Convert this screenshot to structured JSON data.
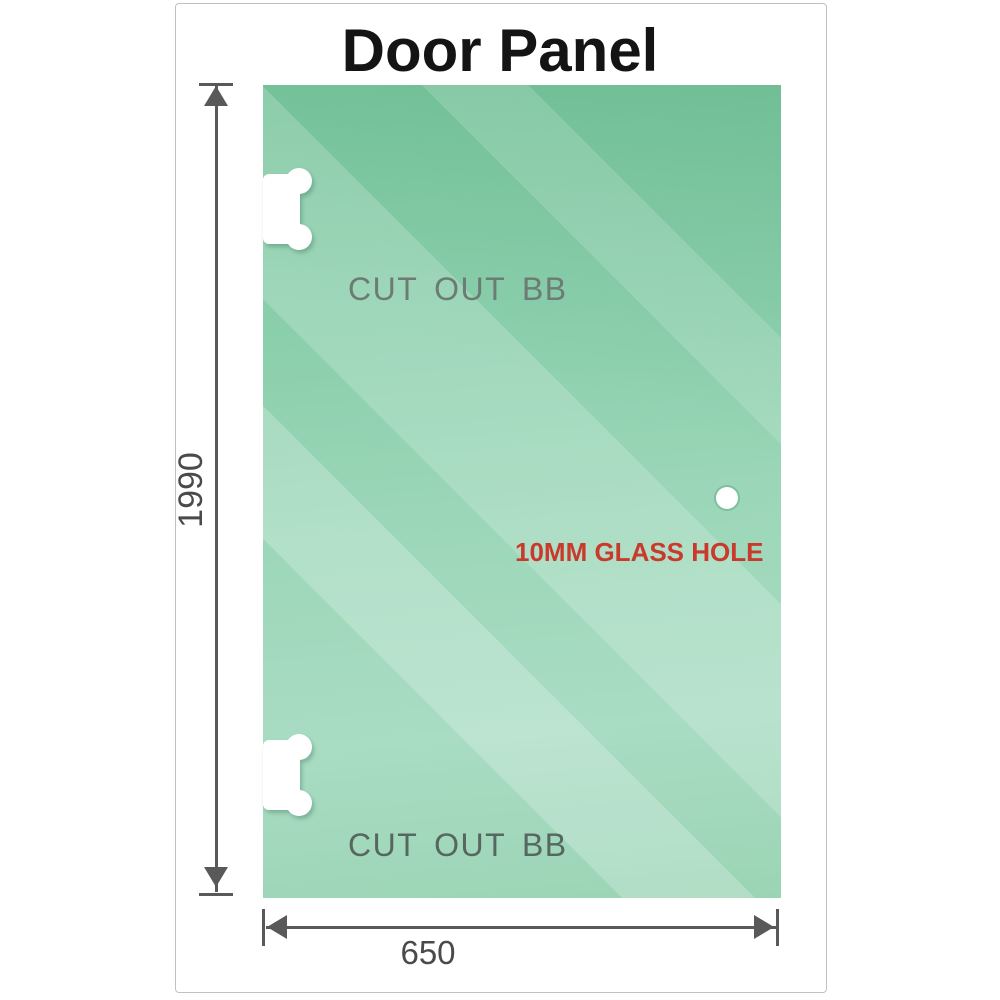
{
  "title": "Door Panel",
  "panel": {
    "cutouts": [
      {
        "label": "CUT OUT BB"
      },
      {
        "label": "CUT OUT BB"
      }
    ],
    "hole_label": "10MM GLASS HOLE"
  },
  "dimensions": {
    "height_label": "1990",
    "width_label": "650"
  },
  "colors": {
    "glass_green_top": "#79c69d",
    "glass_green_light": "#a9dcc3",
    "hole_label_red": "#c93a2c",
    "dimension_gray": "#595959",
    "cutout_label_gray": "#6c7b74",
    "card_border": "#bfc3bf"
  }
}
